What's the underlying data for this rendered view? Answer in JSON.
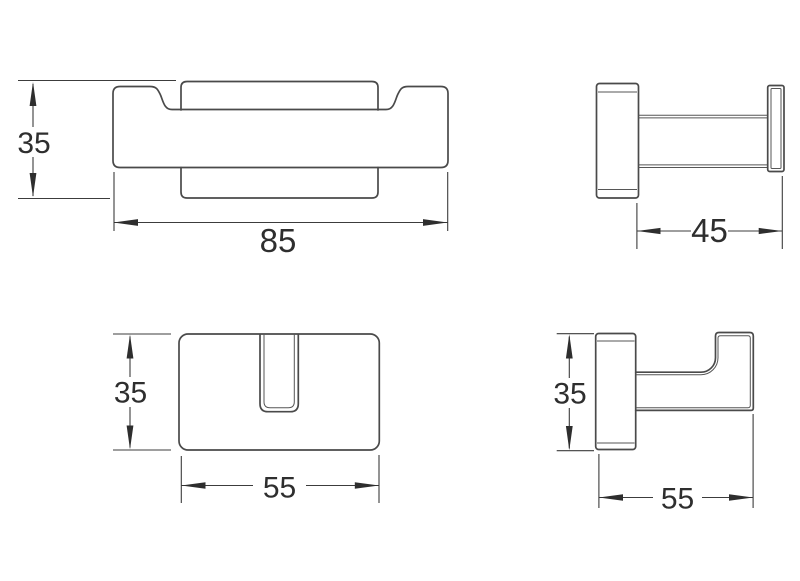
{
  "colors": {
    "background": "#ffffff",
    "outline": "#4a4a4a",
    "dimension_line": "#3c3c3c",
    "text": "#2e2e2e"
  },
  "dimensions": {
    "front_view": {
      "height": "35",
      "width": "85"
    },
    "side_view": {
      "projection": "45"
    },
    "top_view": {
      "depth": "35",
      "width": "55"
    },
    "hook_side_view": {
      "height": "35",
      "projection": "55"
    }
  }
}
